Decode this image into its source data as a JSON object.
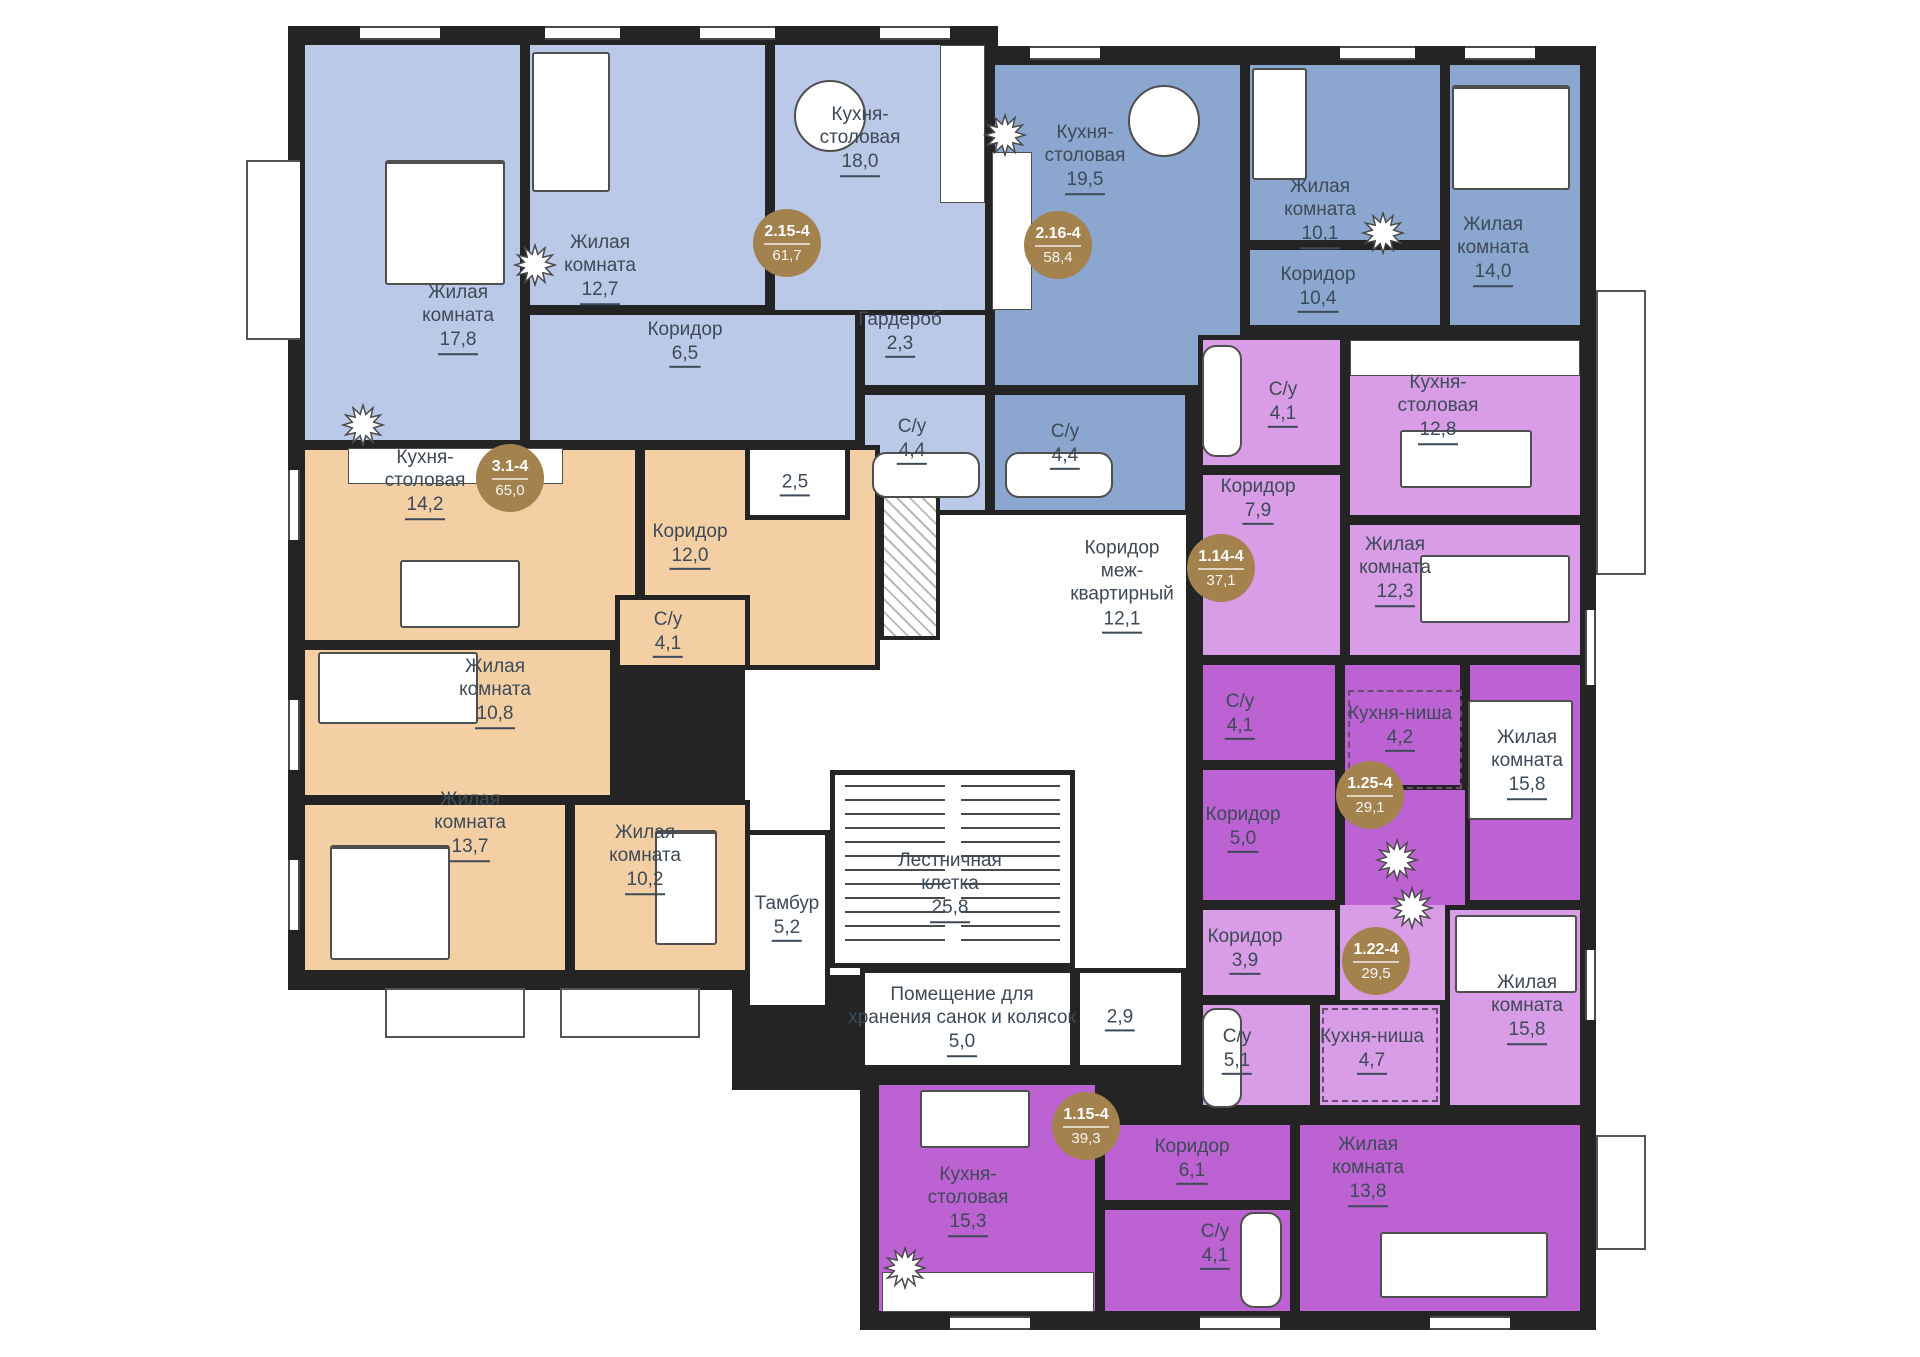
{
  "colors": {
    "wall": "#242424",
    "apartment_2_15_4": "#bac9e8",
    "apartment_2_16_4": "#8ba6cf",
    "apartment_3_1_4": "#f3cfa3",
    "apartment_lilac": "#d99ce6",
    "apartment_purple": "#bd62d2",
    "badge": "#a3824e",
    "label_text": "#3d4a57"
  },
  "apartments": [
    {
      "unit": "2.15-4",
      "area": "61,7",
      "rooms": [
        {
          "name": "Жилая комната",
          "area": "17,8"
        },
        {
          "name": "Жилая комната",
          "area": "12,7"
        },
        {
          "name": "Кухня-столовая",
          "area": "18,0"
        },
        {
          "name": "Коридор",
          "area": "6,5"
        },
        {
          "name": "Гардероб",
          "area": "2,3"
        },
        {
          "name": "С/у",
          "area": "4,4"
        },
        {
          "name": "",
          "area": "2,5"
        }
      ]
    },
    {
      "unit": "2.16-4",
      "area": "58,4",
      "rooms": [
        {
          "name": "Кухня-столовая",
          "area": "19,5"
        },
        {
          "name": "Жилая комната",
          "area": "10,1"
        },
        {
          "name": "Жилая комната",
          "area": "14,0"
        },
        {
          "name": "Коридор",
          "area": "10,4"
        },
        {
          "name": "С/у",
          "area": "4,4"
        }
      ]
    },
    {
      "unit": "3.1-4",
      "area": "65,0",
      "rooms": [
        {
          "name": "Кухня-столовая",
          "area": "14,2"
        },
        {
          "name": "Коридор",
          "area": "12,0"
        },
        {
          "name": "С/у",
          "area": "4,1"
        },
        {
          "name": "Жилая комната",
          "area": "10,8"
        },
        {
          "name": "Жилая комната",
          "area": "13,7"
        },
        {
          "name": "Жилая комната",
          "area": "10,2"
        }
      ]
    },
    {
      "unit": "1.14-4",
      "area": "37,1",
      "rooms": [
        {
          "name": "С/у",
          "area": "4,1"
        },
        {
          "name": "Кухня-столовая",
          "area": "12,8"
        },
        {
          "name": "Коридор",
          "area": "7,9"
        },
        {
          "name": "Жилая комната",
          "area": "12,3"
        }
      ]
    },
    {
      "unit": "1.25-4",
      "area": "29,1",
      "rooms": [
        {
          "name": "С/у",
          "area": "4,1"
        },
        {
          "name": "Кухня-ниша",
          "area": "4,2"
        },
        {
          "name": "Жилая комната",
          "area": "15,8"
        },
        {
          "name": "Коридор",
          "area": "5,0"
        }
      ]
    },
    {
      "unit": "1.22-4",
      "area": "29,5",
      "rooms": [
        {
          "name": "Коридор",
          "area": "3,9"
        },
        {
          "name": "Жилая комната",
          "area": "15,8"
        },
        {
          "name": "С/у",
          "area": "5,1"
        },
        {
          "name": "Кухня-ниша",
          "area": "4,7"
        }
      ]
    },
    {
      "unit": "1.15-4",
      "area": "39,3",
      "rooms": [
        {
          "name": "Кухня-столовая",
          "area": "15,3"
        },
        {
          "name": "Коридор",
          "area": "6,1"
        },
        {
          "name": "С/у",
          "area": "4,1"
        },
        {
          "name": "Жилая комната",
          "area": "13,8"
        }
      ]
    }
  ],
  "common": {
    "rooms": [
      {
        "name": "Тамбур",
        "area": "5,2"
      },
      {
        "name": "Лестничная клетка",
        "area": "25,8"
      },
      {
        "name": "Помещение для хранения санок и колясок",
        "area": "5,0"
      },
      {
        "name": "Коридор меж-квартирный",
        "area": "12,1"
      },
      {
        "name": "",
        "area": "2,9"
      }
    ]
  }
}
